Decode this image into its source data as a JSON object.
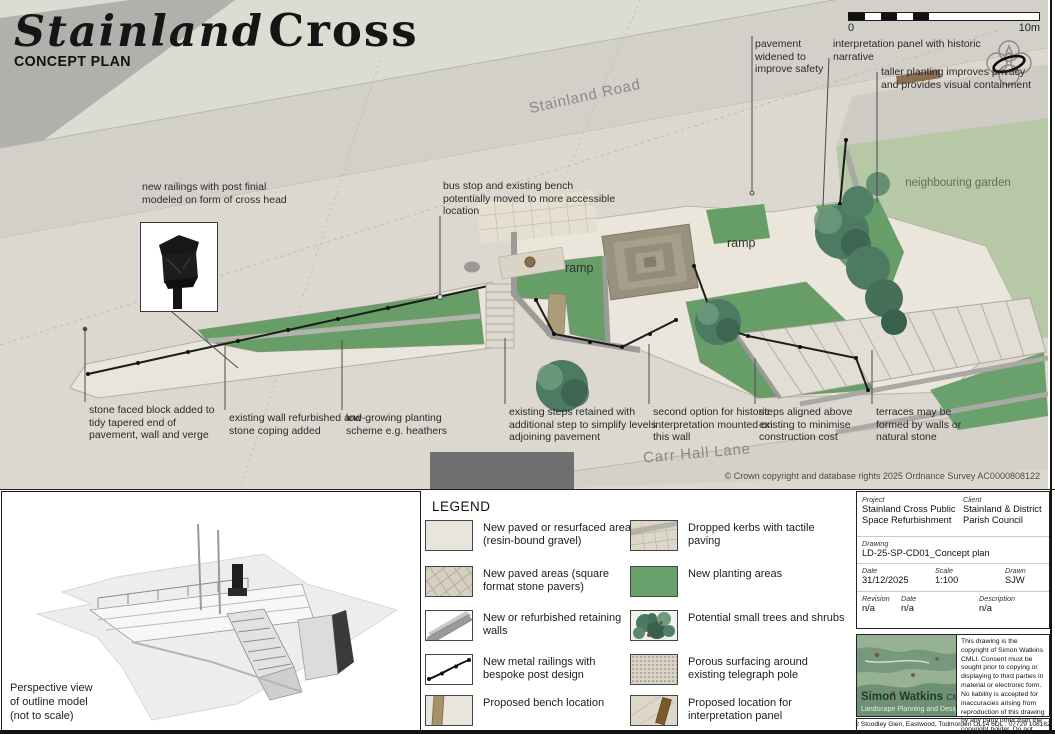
{
  "title": {
    "script": "Stainland",
    "serif": "Cross",
    "subtitle": "CONCEPT PLAN"
  },
  "scalebar": {
    "start": "0",
    "end": "10m"
  },
  "plan": {
    "labels": {
      "stainland_road": "Stainland Road",
      "carr_hall_lane": "Carr Hall Lane",
      "neighbouring_garden": "neighbouring garden",
      "ramp": "ramp",
      "crown_copyright": "© Crown copyright and database rights 2025 Ordnance Survey AC0000808122"
    },
    "annotations": [
      "pavement widened to improve safety",
      "interpretation panel with historic narrative",
      "taller planting improves privacy and provides visual containment",
      "new railings with post finial modeled on form of cross head",
      "bus stop and existing bench potentially moved to more accessible location",
      "stone faced block added to tidy tapered end of pavement, wall and verge",
      "existing wall refurbished and stone coping added",
      "low-growing planting scheme e.g. heathers",
      "existing steps retained with additional step to simplify levels adjoining pavement",
      "second option for historic interpretation mounted on this wall",
      "steps aligned above existing to minimise construction cost",
      "terraces may be formed by walls or natural stone"
    ]
  },
  "perspective": {
    "caption": "Perspective view\nof outline model\n(not to scale)"
  },
  "legend": {
    "heading": "LEGEND",
    "col1": [
      {
        "label": "New paved or resurfaced areas (resin-bound gravel)",
        "swatch": "resin-gravel-swatch"
      },
      {
        "label": "New paved areas (square format stone pavers)",
        "swatch": "stone-pavers-swatch"
      },
      {
        "label": "New or refurbished retaining walls",
        "swatch": "retaining-wall-swatch"
      },
      {
        "label": "New metal railings with bespoke post design",
        "swatch": "metal-railings-swatch"
      },
      {
        "label": "Proposed bench location",
        "swatch": "bench-swatch"
      }
    ],
    "col2": [
      {
        "label": "Dropped kerbs with tactile paving",
        "swatch": "dropped-kerb-swatch"
      },
      {
        "label": "New planting areas",
        "swatch": "planting-swatch"
      },
      {
        "label": "Potential small trees and shrubs",
        "swatch": "trees-swatch"
      },
      {
        "label": "Porous surfacing around existing telegraph pole",
        "swatch": "porous-swatch"
      },
      {
        "label": "Proposed location for interpretation panel",
        "swatch": "interpretation-panel-swatch"
      }
    ]
  },
  "titleblock": {
    "project_label": "Project",
    "project": "Stainland Cross Public Space Refurbishment",
    "client_label": "Client",
    "client": "Stainland & District Parish Council",
    "drawing_label": "Drawing",
    "drawing": "LD-25-SP-CD01_Concept plan",
    "date_label": "Date",
    "date": "31/12/2025",
    "scale_label": "Scale",
    "scale": "1:100",
    "drawn_label": "Drawn",
    "drawn": "SJW",
    "revision_label": "Revision",
    "revision": "n/a",
    "rev_date_label": "Date",
    "rev_date": "n/a",
    "description_label": "Description",
    "description": "n/a"
  },
  "firm": {
    "name": "Simon Watkins",
    "cmli": "CMLI",
    "tagline": "Landscape Planning and Design",
    "copyright": "This drawing is the copyright of Simon Watkins CMLI.  Consent must be sought prior to copying or displaying to third parties in material or electronic form.  No liability is accepted for inaccuracies arising from reproduction of this drawing by any party other than the copyright holder.  Do not scale from this drawing.",
    "address": "2 Stoodley Glen, Eastwood, Todmorden OL14 6DL : 07729 108162"
  },
  "colors": {
    "planting_green": "#679e68",
    "garden_green": "#b7c8a6",
    "paving_cream": "#eae6db",
    "road_grey": "#d3d0ca",
    "map_sage": "#d9ddd2",
    "wall_grey": "#9b9b98",
    "bench_tan": "#ab9d7a",
    "panel_brown": "#7a5a33",
    "logo_green": "#97b195"
  }
}
